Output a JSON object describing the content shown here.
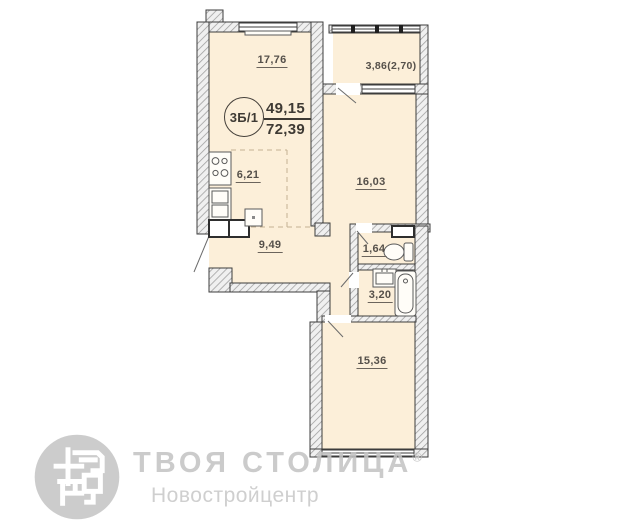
{
  "plan": {
    "badge": {
      "type": "3Б/1",
      "area_living": "49,15",
      "area_total": "72,39"
    },
    "rooms": [
      {
        "id": "living-room",
        "area": "17,76"
      },
      {
        "id": "loggia",
        "area": "3,86(2,70)"
      },
      {
        "id": "kitchen",
        "area": "6,21"
      },
      {
        "id": "room-1",
        "area": "16,03"
      },
      {
        "id": "hall",
        "area": "9,49"
      },
      {
        "id": "wc",
        "area": "1,64"
      },
      {
        "id": "bathroom",
        "area": "3,20"
      },
      {
        "id": "room-2",
        "area": "15,36"
      }
    ]
  },
  "watermark": {
    "brand": "ТВОЯ СТОЛИЦА",
    "registered": "®",
    "subtitle": "Новостройцентр"
  },
  "colors": {
    "room_fill": "#fcefd9",
    "wall_line": "#3c3c3c",
    "hatch": "#9c9c9c",
    "label_text": "#55504a",
    "watermark_gray": "#c6c6c6"
  }
}
